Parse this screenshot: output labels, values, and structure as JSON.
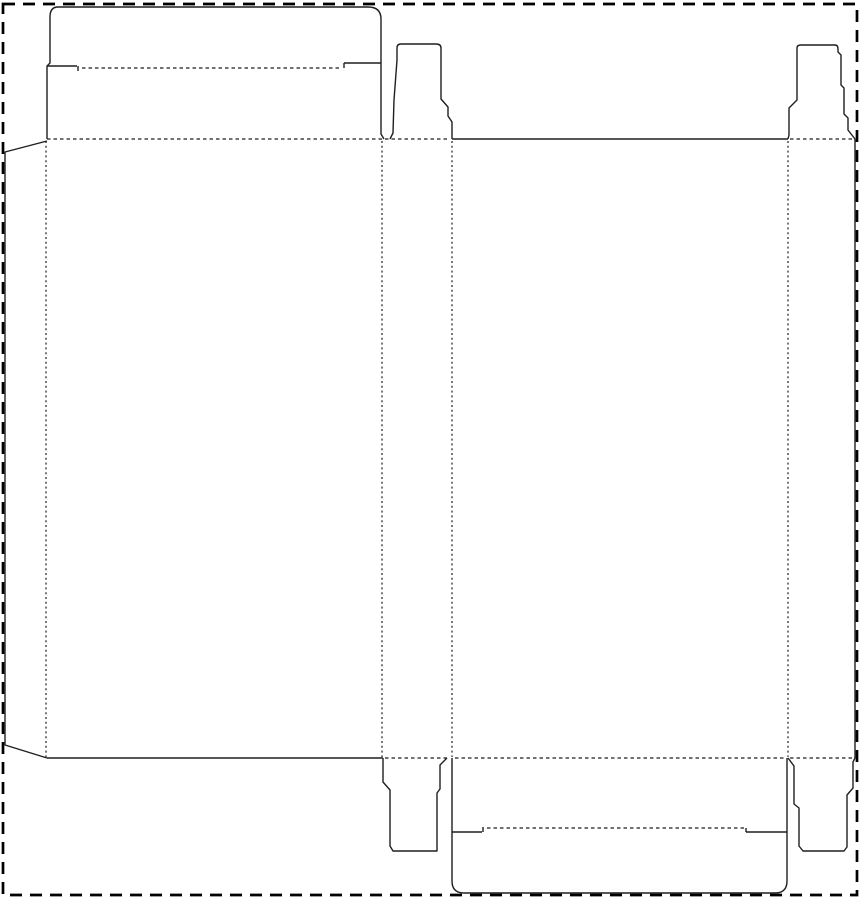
{
  "canvas": {
    "width": 861,
    "height": 900,
    "background": "#ffffff"
  },
  "colors": {
    "cut_line": "#1f1f1f",
    "fold_line": "#1f1f1f",
    "sheet_border": "#000000"
  },
  "sheet_border": {
    "x": 3,
    "y": 4,
    "w": 854,
    "h": 891,
    "dash": "12 8",
    "stroke_width": 2.7
  },
  "dieline": {
    "cut_width": 1.4,
    "fold_width": 1.2,
    "cut_paths": [
      {
        "name": "cut-lid-outline",
        "d": "M 47 139 L 47 66 L 50 63 L 50 17 Q 50 7 58 7 L 368 7 Q 381 7 381 19 L 381 134 L 384 139"
      },
      {
        "name": "cut-lid-lock-slits",
        "d": "M 47 66 H 77 M 78 66 V 71 M 344 68 V 63 M 344 63 H 381"
      },
      {
        "name": "cut-glue-flap",
        "d": "M 47 141 L 5 152 L 5 745 L 47 758"
      },
      {
        "name": "cut-dust-flap-top-left",
        "d": "M 390 139 L 393 133 L 394 100 L 397 60 L 397 48 Q 397 44 401 44 L 436 44 Q 441 44 441 48 L 441 99 L 448 107 L 448 116 L 452 122 L 452 139"
      },
      {
        "name": "cut-top-edge-back-panel",
        "d": "M 452 139 H 788"
      },
      {
        "name": "cut-dust-flap-top-right",
        "d": "M 788 139 L 789 135 L 789 108 L 797 100 L 797 48 Q 797 45 801 45 L 835 45 Q 838 45 838 49 L 838 52 L 841 55 L 841 85 L 844 88 L 844 114 L 848 118 L 848 130 L 855 139"
      },
      {
        "name": "cut-right-edge",
        "d": "M 855 139 L 855 758"
      },
      {
        "name": "cut-bottom-edge-front-panel",
        "d": "M 47 758 H 383"
      },
      {
        "name": "cut-dust-flap-bottom-left",
        "d": "M 383 758 L 383 782 L 390 790 L 390 846 L 393 851 L 437 851 L 437 793 L 440 789 L 440 765 L 447 758"
      },
      {
        "name": "cut-bottom-flap-outline",
        "d": "M 452 758 L 452 881 Q 452 893 464 893 L 775 893 Q 787 893 787 881 L 787 758"
      },
      {
        "name": "cut-bottom-flap-lock-slits",
        "d": "M 452 832 H 482 M 483 832 V 827 M 746 828 V 832 M 746 832 H 787"
      },
      {
        "name": "cut-dust-flap-bottom-right",
        "d": "M 788 758 L 794 766 L 794 804 L 799 808 L 799 846 L 803 851 L 844 851 L 847 847 L 847 795 L 853 788 L 853 762 L 855 758"
      }
    ],
    "fold_paths": [
      {
        "name": "fold-glue-flap",
        "d": "M 46 141 V 757",
        "dash": "2 2.8"
      },
      {
        "name": "fold-panel-1-2",
        "d": "M 382 141 V 757",
        "dash": "2 2.8"
      },
      {
        "name": "fold-panel-2-3",
        "d": "M 452 141 V 757",
        "dash": "2 2.8"
      },
      {
        "name": "fold-panel-3-4",
        "d": "M 788 141 V 757",
        "dash": "2 2.8"
      },
      {
        "name": "fold-top-edge",
        "d": "M 47 139 H 450 M 790 139 H 853",
        "dash": "3.5 3"
      },
      {
        "name": "fold-bottom-edge",
        "d": "M 385 758 H 450 M 455 758 H 786 M 790 758 H 855",
        "dash": "3.5 3"
      },
      {
        "name": "fold-lid-tuck",
        "d": "M 82 68 H 342",
        "dash": "3.5 3"
      },
      {
        "name": "fold-bottom-flap-tuck",
        "d": "M 487 828 H 744",
        "dash": "3.5 3"
      }
    ]
  }
}
